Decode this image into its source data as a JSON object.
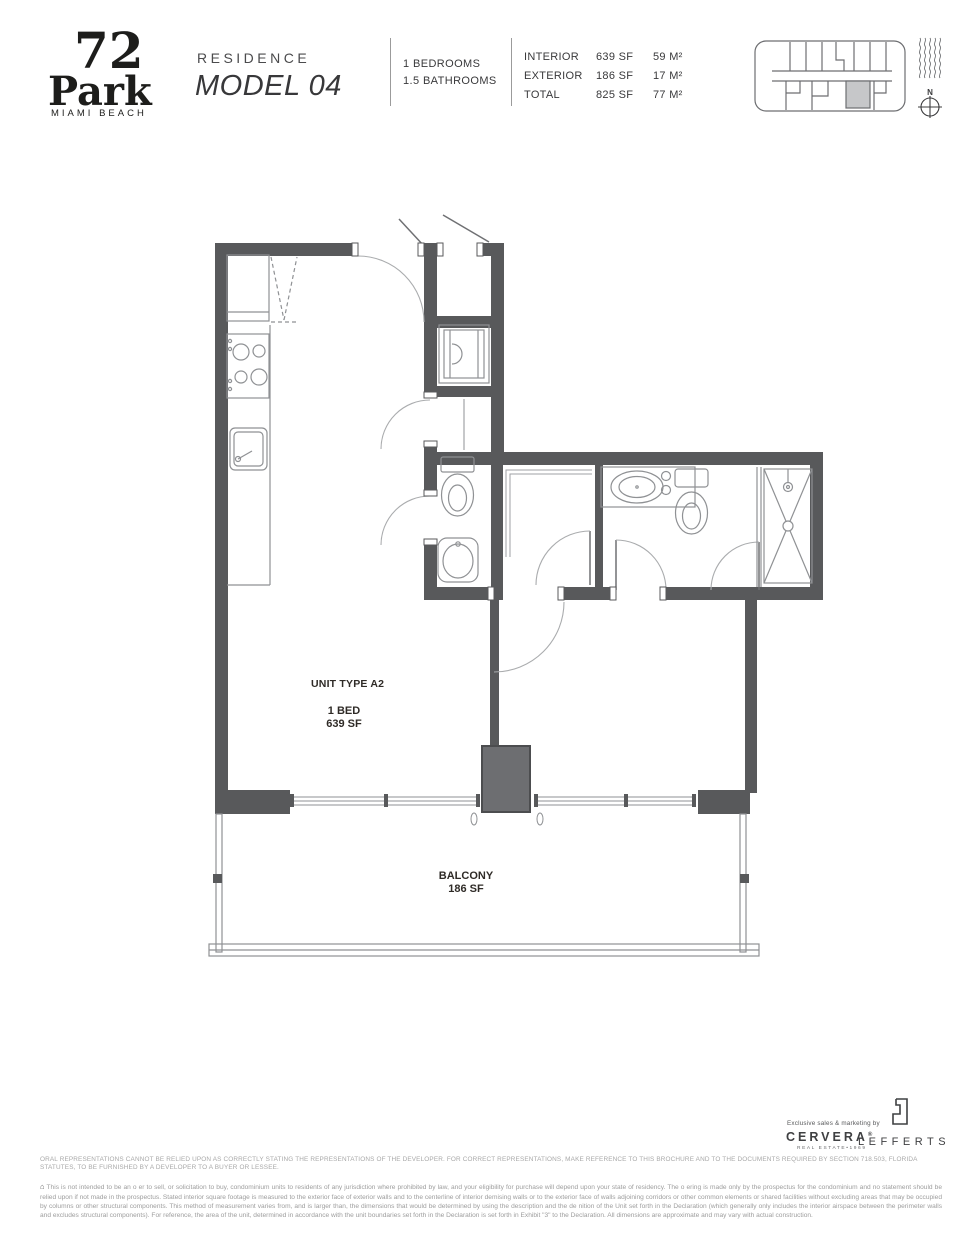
{
  "header": {
    "logo": {
      "number": "72",
      "name": "Park",
      "city": "MIAMI BEACH"
    },
    "residence_label": "RESIDENCE",
    "model": "MODEL 04",
    "bedrooms": "1 BEDROOMS",
    "bathrooms": "1.5 BATHROOMS",
    "stats": [
      {
        "label": "INTERIOR",
        "sf": "639 SF",
        "m2": "59 M²"
      },
      {
        "label": "EXTERIOR",
        "sf": "186 SF",
        "m2": "17 M²"
      },
      {
        "label": "TOTAL",
        "sf": "825 SF",
        "m2": "77 M²"
      }
    ],
    "compass_label": "N"
  },
  "plan": {
    "unit_type": "UNIT TYPE A2",
    "bed_label": "1 BED",
    "area_label": "639 SF",
    "balcony_label": "BALCONY",
    "balcony_area": "186 SF"
  },
  "footer": {
    "marketing_note": "Exclusive sales & marketing by",
    "cervera": "CERVERA",
    "cervera_reg": "®",
    "cervera_sub": "REAL ESTATE•1969",
    "lefferts": "LEFFERTS",
    "footnote_glyph": "⌂",
    "disclaimer_1": "ORAL REPRESENTATIONS CANNOT BE RELIED UPON AS CORRECTLY STATING THE REPRESENTATIONS OF THE DEVELOPER. FOR CORRECT REPRESENTATIONS, MAKE REFERENCE TO THIS BROCHURE AND TO THE DOCUMENTS REQUIRED BY SECTION 718.503, FLORIDA STATUTES, TO BE FURNISHED BY A DEVELOPER TO A BUYER OR LESSEE.",
    "disclaimer_2": "This is not intended to be an o er to sell, or solicitation to buy, condominium units to residents of any jurisdiction where prohibited by law, and your eligibility for purchase will depend upon your state of residency. The o ering is made only by the prospectus for the condominium and no statement should be relied upon if not made in the prospectus. Stated interior square footage is measured to the exterior face of exterior walls and to the centerline of interior demising walls or to the exterior face of walls adjoining corridors or other common elements or shared facilities without excluding areas that may be occupied by columns or other structural components. This method of measurement varies from, and is larger than, the dimensions that would be determined by using the description and the de nition of the Unit set forth in the Declaration (which generally only includes the interior airspace between the perimeter walls and excludes structural components). For reference, the area of the unit, determined in accordance with the unit boundaries set forth in the Declaration is set forth in Exhibit \"3\" to the Declaration. All dimensions are approximate and may vary with actual construction."
  },
  "colors": {
    "wall": "#58595b",
    "column": "#6d6e71",
    "fixture_line": "#8f9194",
    "door_arc": "#aaacae",
    "keyplan_highlight": "#c6c7c9",
    "label_text": "#2f2b27",
    "disclaimer_text": "#a0a0a0"
  }
}
